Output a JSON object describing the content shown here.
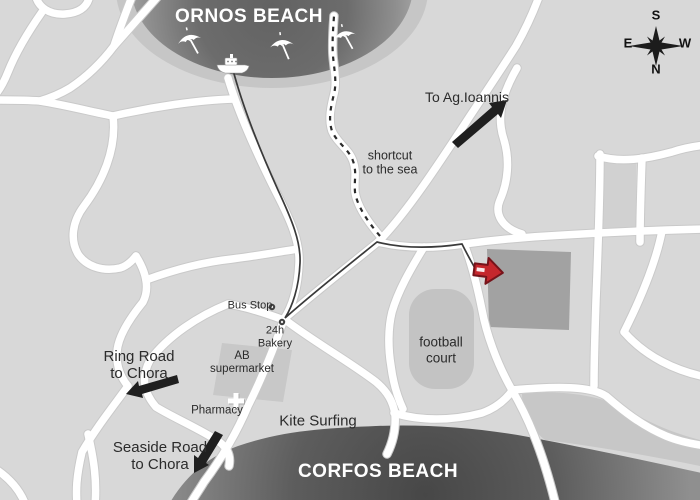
{
  "map": {
    "beaches": {
      "top": "ORNOS BEACH",
      "bottom": "CORFOS BEACH"
    },
    "compass": {
      "top": "S",
      "left": "E",
      "right": "W",
      "bottom": "N"
    },
    "labels": {
      "to_ag_ioannis": "To Ag.Ioannis",
      "shortcut": [
        "shortcut",
        "to the sea"
      ],
      "bus_stop": "Bus Stop",
      "bakery": [
        "24h",
        "Bakery"
      ],
      "supermarket": [
        "AB",
        "supermarket"
      ],
      "pharmacy": "Pharmacy",
      "football_court": [
        "football",
        "court"
      ],
      "kite_surfing": "Kite Surfing",
      "ring_road": [
        "Ring Road",
        "to Chora"
      ],
      "seaside_road": [
        "Seaside Road",
        "to Chora"
      ]
    },
    "colors": {
      "background": "#d8d8d8",
      "road": "#ffffff",
      "beach_gradient_dark": "#474747",
      "building_block": "#a2a2a2",
      "court_block": "#c3c3c3",
      "arrow_black": "#1f1f1f",
      "destination_marker_red": "#c5272d",
      "route_line": "#3a3a3a"
    },
    "icons": {
      "compass": "compass-rose-icon",
      "umbrellas": "beach-umbrella-icon",
      "boat": "boat-icon",
      "pharmacy_cross": "pharmacy-cross-icon",
      "bus_stop_marker": "poi-dot-icon",
      "bakery_marker": "poi-dot-icon",
      "destination": "red-arrow-icon"
    }
  }
}
